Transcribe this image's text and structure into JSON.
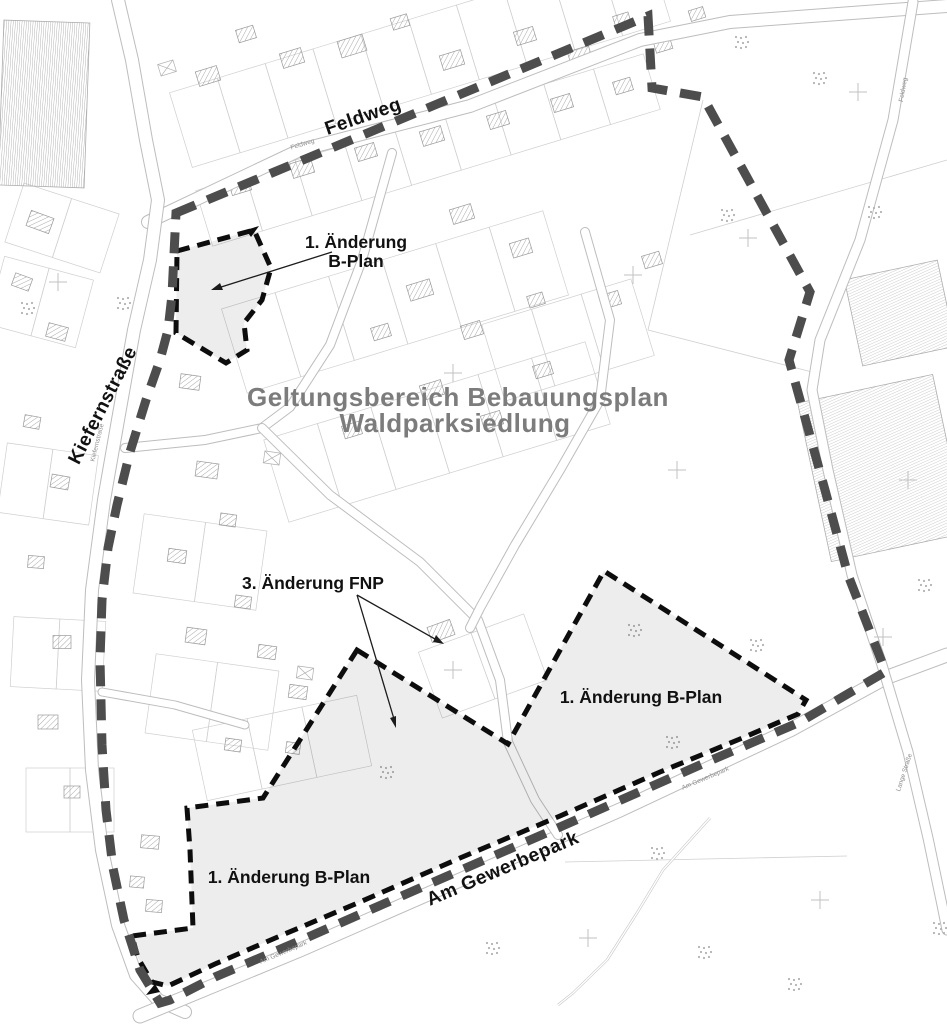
{
  "colors": {
    "boundary": "#4d4d4d",
    "change_border": "#0d0d0d",
    "shade": "rgba(0,0,0,0.07)",
    "title": "#7c7c7c",
    "label": "#111111",
    "basemap_line": "#cfcfcf"
  },
  "annotations": {
    "title_line1": "Geltungsbereich Bebauungsplan",
    "title_line2": "Waldparksiedlung",
    "area1_line1": "1. Änderung",
    "area1_line2": "B-Plan",
    "fnp": "3. Änderung FNP",
    "area_right": "1. Änderung B-Plan",
    "area_bottom": "1. Änderung B-Plan"
  },
  "street_labels": {
    "feldweg": "Feldweg",
    "kiefernstrasse": "Kiefernstraße",
    "am_gewerbepark": "Am Gewerbepark"
  },
  "boundary": {
    "outer": "176,213 648,16 652,88 703,97 810,292 789,360 825,490 848,575 883,665 885,672 800,722 700,765 560,827 420,888 290,945 215,977 170,1000 160,1003 140,970 124,920 113,868 106,810 102,745 100,660 102,600 108,548 117,505 130,452 146,400 160,360 168,330 172,295"
  },
  "change_areas": {
    "area1": "177,251 254,230 271,268 262,300 244,323 247,350 226,363 176,333",
    "area2": "357,650 508,744 604,571 806,700 798,714 740,739 660,772 560,816 460,858 360,902 280,936 215,964 168,986 152,982 138,958 132,936 193,928 190,850 187,808 263,798",
    "wedge1": "259,226 251,237 246,230",
    "wedge2": "146,995 155,984 160,992"
  },
  "arrows": {
    "a1": {
      "line": "332,252 218,288",
      "head": "211,290 220,283 223,290"
    },
    "a2": {
      "line": "357,595 435,639",
      "head": "444,644 433,642 436,635"
    },
    "a3": {
      "line": "357,595 394,719",
      "head": "396,728 390,718 396,716"
    }
  },
  "map": {
    "small_labels": [
      {
        "text": "Feldweg"
      },
      {
        "text": "Kiefernstraße"
      },
      {
        "text": "Am Gewerbepark"
      },
      {
        "text": "Am Gewerbepark"
      },
      {
        "text": "Lange Straße"
      },
      {
        "text": "Feldweg"
      }
    ],
    "streets": [
      {
        "pts": "148,222 300,150 470,106 640,40 730,22 947,6",
        "w": 12
      },
      {
        "pts": "118,0 132,60 146,140 158,200 150,260 134,330 118,420 104,500 92,590 88,680 92,770 102,850 118,925 136,975 158,1000 185,1012",
        "w": 12
      },
      {
        "pts": "140,1016 300,950 460,880 620,810 790,730 885,678 947,655",
        "w": 13
      },
      {
        "pts": "913,2 893,120 860,240 820,340 812,390 828,470 852,575 882,665 908,752 928,838 942,905 947,930",
        "w": 9
      },
      {
        "pts": "392,153 362,260 330,345 290,407 262,428 205,440 125,448",
        "w": 8
      },
      {
        "pts": "262,428 330,495 420,562 478,620 500,680 508,742 535,800 558,835",
        "w": 8
      },
      {
        "pts": "585,232 610,320 600,400 560,470 515,545 480,608 470,628",
        "w": 8
      },
      {
        "pts": "102,692 175,705 245,725",
        "w": 7
      }
    ],
    "trail": "710,818 663,870 637,913 607,960 573,993 558,1005",
    "field_lines": [
      "703,100 648,330",
      "648,330 812,372",
      "690,235 947,160",
      "565,862 847,856"
    ],
    "blocks": [
      [
        420,
        57,
        -17,
        10,
        50,
        78
      ],
      [
        428,
        150,
        -17,
        9,
        52,
        58
      ],
      [
        395,
        302,
        -17,
        6,
        56,
        88
      ],
      [
        437,
        432,
        -17,
        6,
        56,
        86
      ],
      [
        568,
        340,
        -17,
        3,
        52,
        80
      ],
      [
        200,
        562,
        8,
        2,
        62,
        80
      ],
      [
        212,
        702,
        8,
        2,
        62,
        80
      ],
      [
        282,
        748,
        -12,
        3,
        56,
        72
      ],
      [
        40,
        302,
        15,
        2,
        46,
        70
      ],
      [
        48,
        484,
        8,
        2,
        46,
        70
      ],
      [
        58,
        654,
        3,
        2,
        46,
        70
      ],
      [
        70,
        800,
        0,
        2,
        44,
        64
      ],
      [
        483,
        666,
        -20,
        2,
        56,
        70
      ],
      [
        62,
        228,
        18,
        2,
        50,
        62
      ]
    ],
    "houses": [
      [
        208,
        76,
        22,
        15,
        -17
      ],
      [
        246,
        34,
        18,
        13,
        -17
      ],
      [
        292,
        58,
        22,
        15,
        -17
      ],
      [
        352,
        46,
        26,
        17,
        -17
      ],
      [
        400,
        22,
        17,
        12,
        -17
      ],
      [
        452,
        60,
        22,
        15,
        -17
      ],
      [
        525,
        36,
        20,
        14,
        -17
      ],
      [
        580,
        56,
        22,
        15,
        -17
      ],
      [
        622,
        20,
        16,
        12,
        -17
      ],
      [
        663,
        45,
        17,
        12,
        -17
      ],
      [
        697,
        14,
        15,
        11,
        -17
      ],
      [
        240,
        186,
        20,
        14,
        -17
      ],
      [
        302,
        168,
        22,
        15,
        -17
      ],
      [
        366,
        152,
        20,
        14,
        -17
      ],
      [
        432,
        136,
        22,
        15,
        -17
      ],
      [
        498,
        120,
        20,
        14,
        -17
      ],
      [
        562,
        103,
        20,
        14,
        -17
      ],
      [
        623,
        86,
        18,
        13,
        -17
      ],
      [
        462,
        214,
        22,
        15,
        -17
      ],
      [
        521,
        248,
        20,
        15,
        -17
      ],
      [
        420,
        290,
        24,
        16,
        -17
      ],
      [
        472,
        330,
        20,
        14,
        -17
      ],
      [
        381,
        332,
        18,
        13,
        -17
      ],
      [
        432,
        390,
        22,
        15,
        -17
      ],
      [
        352,
        430,
        18,
        13,
        -17
      ],
      [
        492,
        420,
        20,
        14,
        -17
      ],
      [
        543,
        370,
        18,
        13,
        -17
      ],
      [
        610,
        300,
        20,
        14,
        -17
      ],
      [
        652,
        260,
        18,
        13,
        -17
      ],
      [
        536,
        300,
        16,
        12,
        -17
      ],
      [
        190,
        382,
        20,
        14,
        8
      ],
      [
        207,
        470,
        22,
        15,
        8
      ],
      [
        177,
        556,
        18,
        13,
        8
      ],
      [
        228,
        520,
        16,
        12,
        8
      ],
      [
        196,
        636,
        20,
        15,
        8
      ],
      [
        243,
        602,
        16,
        12,
        8
      ],
      [
        267,
        652,
        18,
        13,
        8
      ],
      [
        298,
        692,
        18,
        13,
        8
      ],
      [
        233,
        745,
        16,
        12,
        8
      ],
      [
        293,
        748,
        14,
        11,
        8
      ],
      [
        150,
        842,
        18,
        13,
        5
      ],
      [
        137,
        882,
        14,
        11,
        5
      ],
      [
        154,
        906,
        16,
        12,
        5
      ],
      [
        40,
        222,
        24,
        16,
        20
      ],
      [
        22,
        282,
        18,
        13,
        20
      ],
      [
        57,
        332,
        20,
        14,
        15
      ],
      [
        32,
        422,
        16,
        12,
        10
      ],
      [
        60,
        482,
        18,
        13,
        10
      ],
      [
        36,
        562,
        16,
        12,
        5
      ],
      [
        62,
        642,
        18,
        13,
        0
      ],
      [
        48,
        722,
        20,
        14,
        0
      ],
      [
        72,
        792,
        16,
        12,
        0
      ],
      [
        441,
        631,
        24,
        16,
        -20
      ]
    ],
    "xboxes": [
      [
        167,
        68,
        16,
        12,
        -17
      ],
      [
        272,
        458,
        16,
        12,
        8
      ],
      [
        305,
        673,
        16,
        12,
        8
      ]
    ],
    "industrial": [
      [
        900,
        313,
        95,
        88,
        -12,
        "ind"
      ],
      [
        882,
        468,
        138,
        162,
        -12,
        "ind"
      ],
      [
        44,
        104,
        86,
        165,
        2,
        "stripes"
      ]
    ],
    "tree_clusters": [
      [
        742,
        42
      ],
      [
        820,
        78
      ],
      [
        875,
        212
      ],
      [
        728,
        215
      ],
      [
        635,
        630
      ],
      [
        757,
        645
      ],
      [
        925,
        585
      ],
      [
        673,
        742
      ],
      [
        387,
        772
      ],
      [
        705,
        952
      ],
      [
        940,
        928
      ],
      [
        493,
        948
      ],
      [
        28,
        308
      ],
      [
        124,
        303
      ],
      [
        658,
        853
      ],
      [
        795,
        984
      ]
    ],
    "crosses": [
      [
        748,
        238
      ],
      [
        858,
        92
      ],
      [
        908,
        480
      ],
      [
        633,
        275
      ],
      [
        677,
        470
      ],
      [
        453,
        670
      ],
      [
        883,
        637
      ],
      [
        588,
        938
      ],
      [
        820,
        900
      ],
      [
        58,
        282
      ],
      [
        453,
        373
      ]
    ]
  }
}
